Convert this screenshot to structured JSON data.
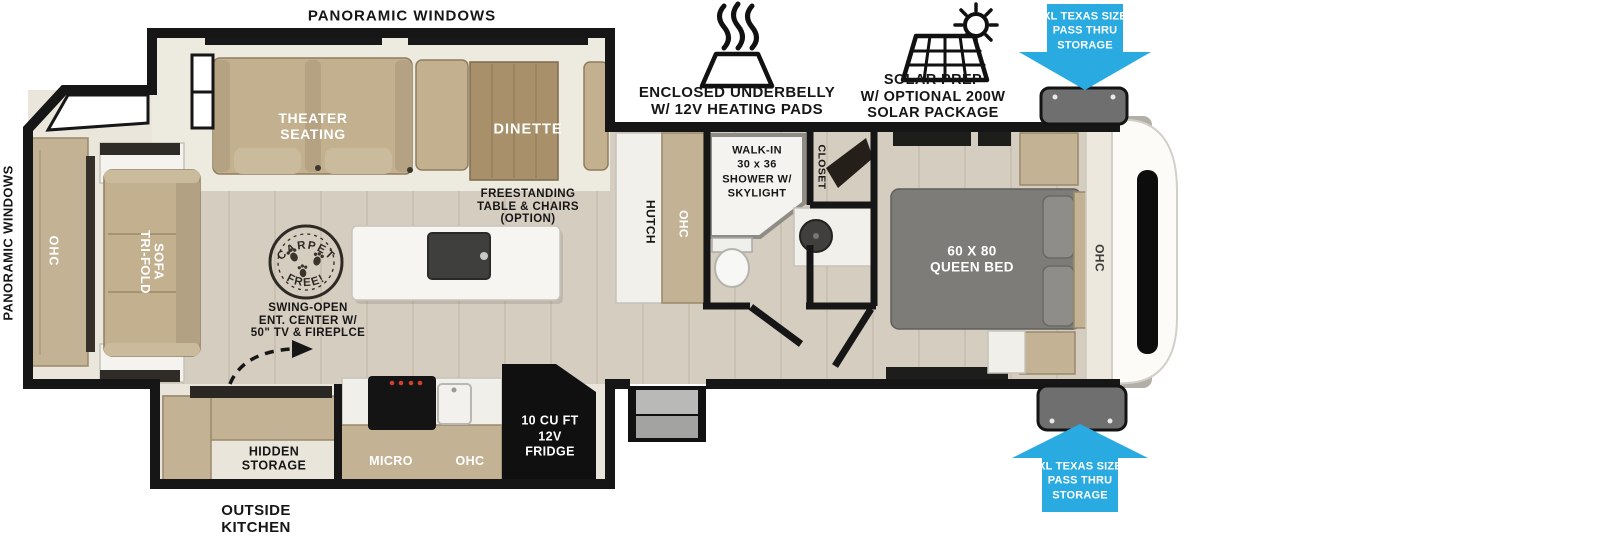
{
  "colors": {
    "accent_blue": "#29ABE2",
    "wall_black": "#161616",
    "furniture_tan": "#C4B295",
    "wood_floor": "#D5CDC0",
    "cream_interior": "#EBE7DC",
    "bed_gray": "#7D7C78"
  },
  "exterior_labels": {
    "panoramic_windows_top": "PANORAMIC WINDOWS",
    "panoramic_windows_rear": "PANORAMIC WINDOWS",
    "outside_kitchen": "OUTSIDE\nKITCHEN",
    "pass_thru_top": "XL TEXAS SIZE\nPASS THRU\nSTORAGE",
    "pass_thru_bottom": "XL TEXAS SIZE\nPASS THRU\nSTORAGE"
  },
  "features": {
    "underbelly": "ENCLOSED UNDERBELLY\nW/ 12V HEATING PADS",
    "solar": "SOLAR PREP\nW/ OPTIONAL 200W\nSOLAR PACKAGE"
  },
  "living_area": {
    "theater_seating": "THEATER\nSEATING",
    "dinette": "DINETTE",
    "tri_fold_sofa": "TRI-FOLD\nSOFA",
    "ohc_rear": "OHC",
    "freestanding_table": "FREESTANDING\nTABLE & CHAIRS\n(OPTION)",
    "swing_open_ent": "SWING-OPEN\nENT. CENTER W/\n50\" TV & FIREPLCE",
    "carpet_free": {
      "arc_top": "CARPET",
      "arc_bottom": "FREE!"
    },
    "hutch": "HUTCH",
    "ohc_hutch": "OHC"
  },
  "kitchen": {
    "micro": "MICRO",
    "ohc": "OHC",
    "fridge": "10 CU FT\n12V\nFRIDGE",
    "hidden_storage": "HIDDEN\nSTORAGE"
  },
  "bathroom": {
    "shower": "WALK-IN\n30 x 36\nSHOWER W/\nSKYLIGHT",
    "closet": "CLOSET"
  },
  "bedroom": {
    "bed": "60 X 80\nQUEEN BED",
    "ohc": "OHC"
  }
}
